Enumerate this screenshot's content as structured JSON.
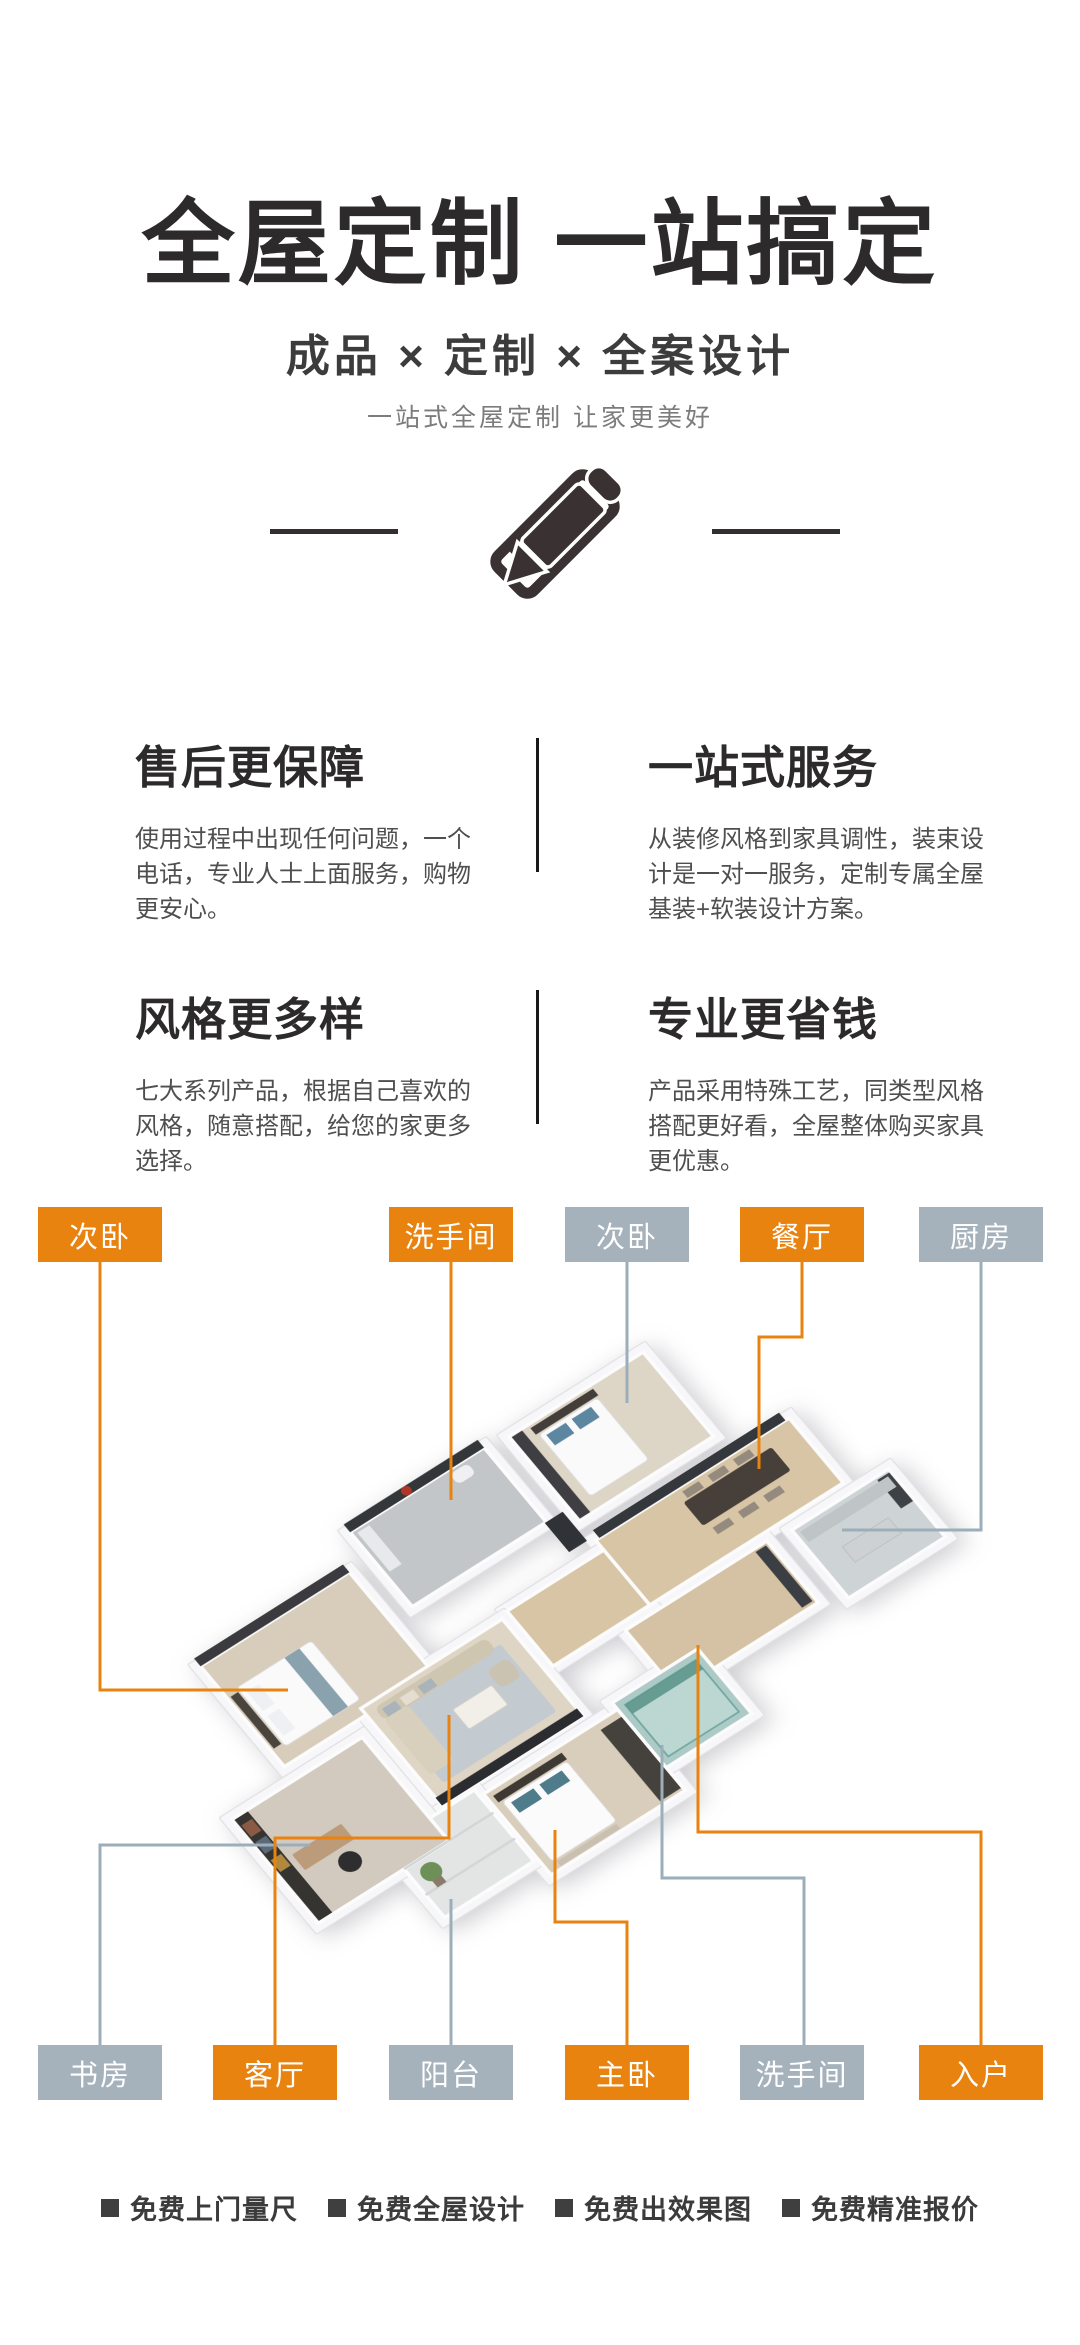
{
  "header": {
    "title": "全屋定制 一站搞定",
    "subtitle": "成品 × 定制 × 全案设计",
    "tagline": "一站式全屋定制 让家更美好",
    "icon": "pencil-ruler-icon"
  },
  "features": [
    {
      "title": "售后更保障",
      "desc": "使用过程中出现任何问题，一个电话，专业人士上面服务，购物更安心。"
    },
    {
      "title": "一站式服务",
      "desc": "从装修风格到家具调性，装束设计是一对一服务，定制专属全屋基装+软装设计方案。"
    },
    {
      "title": "风格更多样",
      "desc": "七大系列产品，根据自己喜欢的风格，随意搭配，给您的家更多选择。"
    },
    {
      "title": "专业更省钱",
      "desc": "产品采用特殊工艺，同类型风格搭配更好看，全屋整体购买家具更优惠。"
    }
  ],
  "floorplan": {
    "top_labels": [
      {
        "label": "次卧",
        "style": "orange"
      },
      {
        "label": "洗手间",
        "style": "orange"
      },
      {
        "label": "次卧",
        "style": "gray"
      },
      {
        "label": "餐厅",
        "style": "orange"
      },
      {
        "label": "厨房",
        "style": "gray"
      }
    ],
    "bottom_labels": [
      {
        "label": "书房",
        "style": "gray"
      },
      {
        "label": "客厅",
        "style": "orange"
      },
      {
        "label": "阳台",
        "style": "gray"
      },
      {
        "label": "主卧",
        "style": "orange"
      },
      {
        "label": "洗手间",
        "style": "gray"
      },
      {
        "label": "入户",
        "style": "orange"
      }
    ],
    "colors": {
      "orange": "#E8830F",
      "gray": "#A5B1BB"
    }
  },
  "footer": {
    "items": [
      "免费上门量尺",
      "免费全屋设计",
      "免费出效果图",
      "免费精准报价"
    ],
    "bullet_icon": "square-bullet-icon"
  },
  "colors": {
    "accent_orange": "#E8830F",
    "label_gray": "#A5B1BB",
    "text_dark": "#2C2A2A"
  }
}
